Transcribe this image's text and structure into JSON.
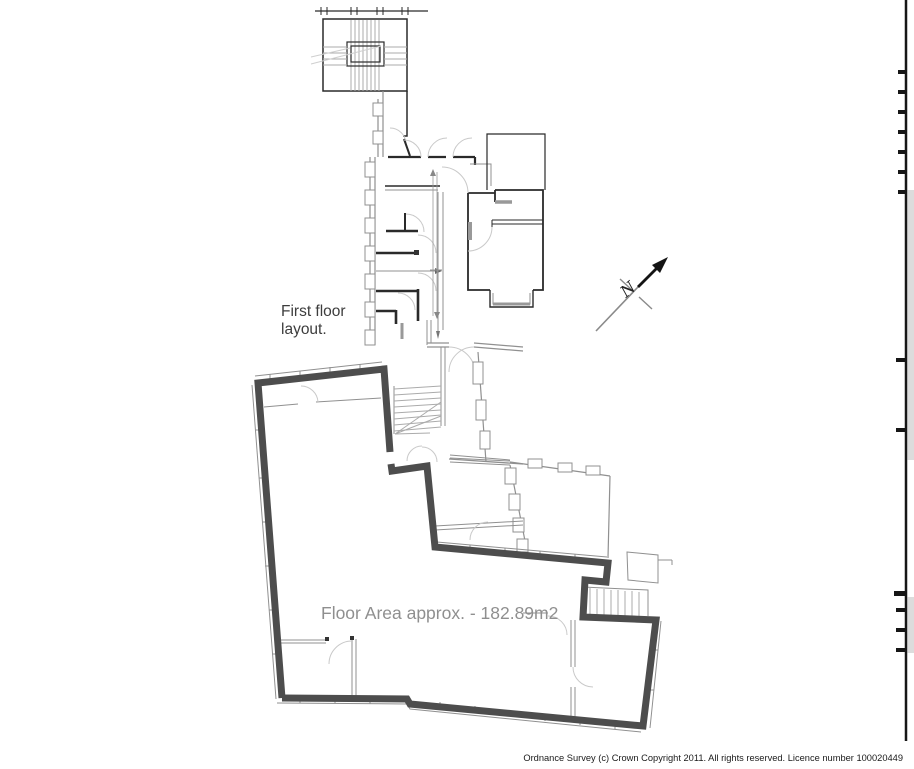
{
  "annotations": {
    "layout_label": {
      "line1": "First floor",
      "line2": "layout."
    },
    "floor_area_label": "Floor Area approx. - 182.89m2",
    "north_label": "N",
    "copyright": "Ordnance Survey (c) Crown Copyright 2011. All rights reserved. Licence number 100020449"
  },
  "colors": {
    "background": "#ffffff",
    "demise_outline": "#4d4d4d",
    "wall_dark": "#2a2a2a",
    "wall_gray": "#909090",
    "wall_light": "#cfcfcf",
    "door_arc": "#c9c9c9",
    "stair_tread": "#ababab",
    "label_dark": "#3d3d3d",
    "label_gray": "#8f8f8f",
    "copyright_color": "#1a1a1a",
    "edge_fill": "#dcdcdc"
  }
}
